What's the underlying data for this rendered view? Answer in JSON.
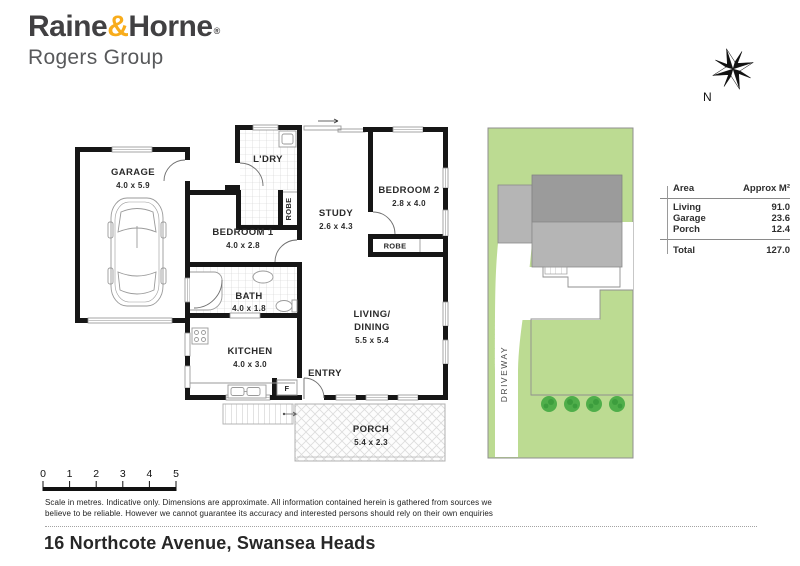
{
  "brand": {
    "name_part1": "Raine",
    "amp": "&",
    "name_part2": "Horne",
    "reg": "®",
    "group": "Rogers Group"
  },
  "compass": {
    "north_label": "N"
  },
  "floorplan": {
    "garage": {
      "name": "GARAGE",
      "dims": "4.0 x 5.9"
    },
    "laundry": {
      "name": "L'DRY"
    },
    "bedroom1": {
      "name": "BEDROOM 1",
      "dims": "4.0 x 2.8"
    },
    "robe1": {
      "name": "ROBE"
    },
    "study": {
      "name": "STUDY",
      "dims": "2.6 x 4.3"
    },
    "bedroom2": {
      "name": "BEDROOM 2",
      "dims": "2.8 x 4.0"
    },
    "robe2": {
      "name": "ROBE"
    },
    "bath": {
      "name": "BATH",
      "dims": "4.0 x 1.8"
    },
    "kitchen": {
      "name": "KITCHEN",
      "dims": "4.0 x 3.0"
    },
    "living": {
      "name_line1": "LIVING/",
      "name_line2": "DINING",
      "dims": "5.5 x 5.4"
    },
    "entry": {
      "name": "ENTRY"
    },
    "fridge": {
      "name": "F"
    },
    "porch": {
      "name": "PORCH",
      "dims": "5.4 x 2.3"
    }
  },
  "siteplan": {
    "driveway_label": "DRIVEWAY"
  },
  "area_table": {
    "header": {
      "area": "Area",
      "approx": "Approx M²"
    },
    "rows": [
      {
        "label": "Living",
        "value": "91.0"
      },
      {
        "label": "Garage",
        "value": "23.6"
      },
      {
        "label": "Porch",
        "value": "12.4"
      }
    ],
    "total": {
      "label": "Total",
      "value": "127.0"
    }
  },
  "scale_bar": {
    "ticks": [
      "0",
      "1",
      "2",
      "3",
      "4",
      "5"
    ]
  },
  "disclaimer": {
    "line1": "Scale in metres. Indicative only. Dimensions are approximate. All information contained herein is gathered from sources we",
    "line2": "believe to be reliable. However we cannot guarantee its accuracy and interested persons should rely on their own enquiries"
  },
  "address": "16 Northcote Avenue, Swansea Heads",
  "colors": {
    "accent": "#F8AC1B",
    "lawn": "#BCDB92",
    "tree": "#4FAE4A",
    "roof_dark": "#9B9B9B",
    "roof_light": "#B5B5B5"
  }
}
